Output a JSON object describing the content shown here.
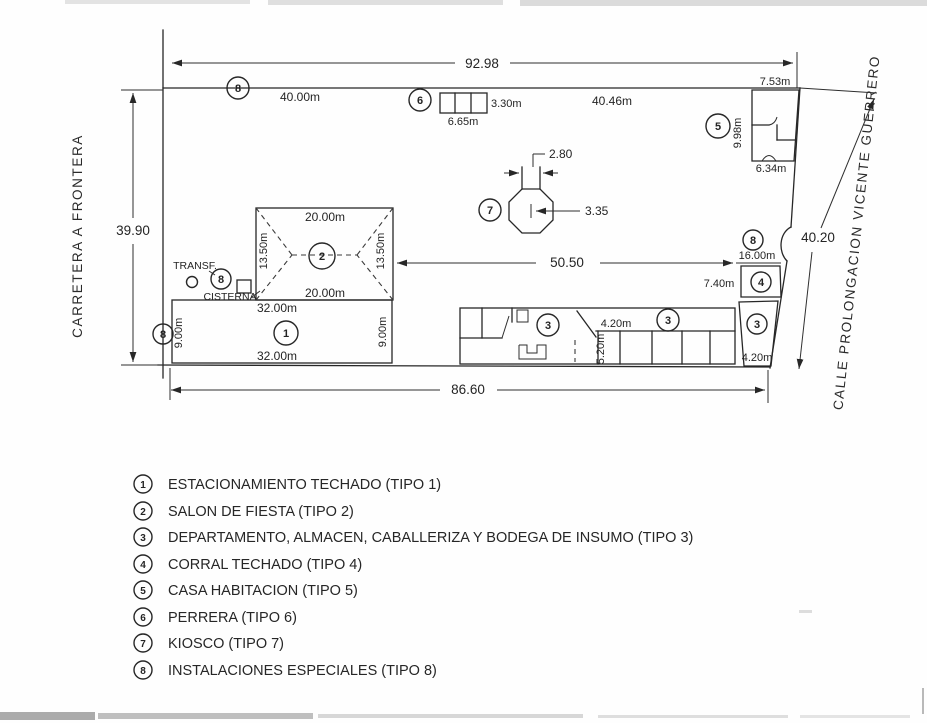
{
  "plan": {
    "streets": {
      "left": "CARRETERA A FRONTERA",
      "right": "CALLE PROLONGACION VICENTE GUERRERO"
    },
    "perimeter": {
      "top": "92.98",
      "left": "39.90",
      "right": "40.20",
      "bottom": "86.60"
    },
    "frontage": {
      "west_segment": "40.00m",
      "east_segment": "40.46m",
      "mid_span": "50.50"
    },
    "buildings": {
      "b1": {
        "num": "1",
        "top": "32.00m",
        "bottom": "32.00m",
        "left": "9.00m",
        "right": "9.00m"
      },
      "b2": {
        "num": "2",
        "top": "20.00m",
        "bottom": "20.00m",
        "left": "13.50m",
        "right": "13.50m"
      },
      "b3": {
        "num": "3",
        "bay_width": "4.20m",
        "bay_depth": "5.20m",
        "east_width": "4.20m"
      },
      "b4": {
        "num": "4",
        "width": "7.40m",
        "frontage": "16.00m"
      },
      "b5": {
        "num": "5",
        "top": "7.53m",
        "side": "9.98m",
        "bottom": "6.34m"
      },
      "b6": {
        "num": "6",
        "depth": "3.30m",
        "width": "6.65m"
      },
      "b7": {
        "num": "7",
        "entry": "2.80",
        "width": "3.35"
      },
      "b8": {
        "num": "8"
      }
    },
    "notes": {
      "transf": "TRANSF.",
      "cisterna": "CISTERNA"
    }
  },
  "legend": {
    "items": [
      {
        "num": "1",
        "label": "ESTACIONAMIENTO TECHADO (TIPO 1)"
      },
      {
        "num": "2",
        "label": "SALON DE FIESTA (TIPO 2)"
      },
      {
        "num": "3",
        "label": "DEPARTAMENTO, ALMACEN, CABALLERIZA Y BODEGA DE INSUMO (TIPO 3)"
      },
      {
        "num": "4",
        "label": "CORRAL TECHADO (TIPO 4)"
      },
      {
        "num": "5",
        "label": "CASA HABITACION (TIPO 5)"
      },
      {
        "num": "6",
        "label": "PERRERA (TIPO 6)"
      },
      {
        "num": "7",
        "label": "KIOSCO (TIPO 7)"
      },
      {
        "num": "8",
        "label": "INSTALACIONES ESPECIALES (TIPO 8)"
      }
    ]
  }
}
